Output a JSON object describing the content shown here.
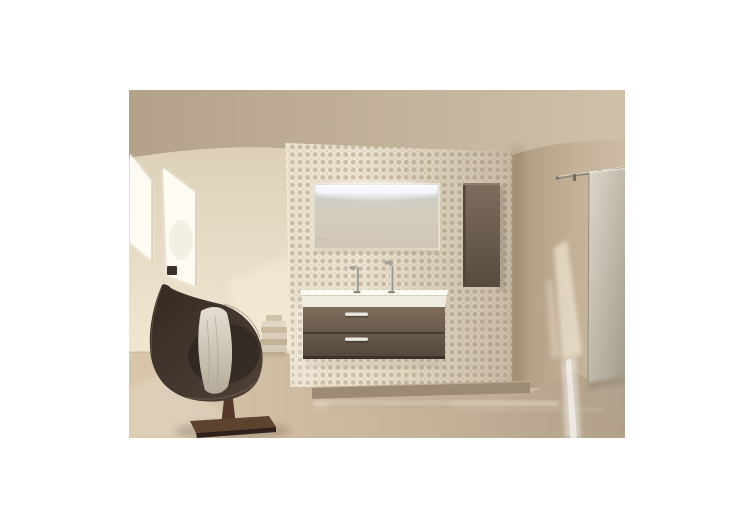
{
  "page": {
    "background": "#ffffff"
  },
  "photo": {
    "alt": "Bathroom interior photograph: mosaic tile accent wall with an illuminated LED mirror, wall-hung taupe vanity with white double washbasin and two chrome taps, tall taupe side cabinet, dark brown swivel lounge chair with a draped towel, slanted skylight windows on the left, sliding glass door on a metal rail to the right, glossy beige floor",
    "colors": {
      "window_light": "#fdfbf2",
      "window_latch": "#3a322a",
      "mosaic_base": "#ebe2d1",
      "mosaic_dot": "#c8b9a0",
      "mirror_frame": "#e9e3d5",
      "led": "#f4f8fe",
      "basin_top": "#fbfaf5",
      "basin_front": "#efece1",
      "chrome": "#e8e6de",
      "plinth": "#9c8b74",
      "rail": "#8f8778",
      "towel_top": "#cfc2a8",
      "towel_1": "#e0d8c6",
      "towel_2": "#c9ba9e",
      "towel_3": "#d8cebb",
      "towel_4": "#c2b296",
      "towel_5": "#d4cab6",
      "chair_hollow": "#221c17",
      "pedestal": "#54392a",
      "sun_patch": "#fdf5e2",
      "ceiling": "#bcab93",
      "wall": "#d8c9b1",
      "cabinet": "#6c5d4e",
      "floor": "#c9b79d",
      "door": "#c5bfb1"
    }
  }
}
